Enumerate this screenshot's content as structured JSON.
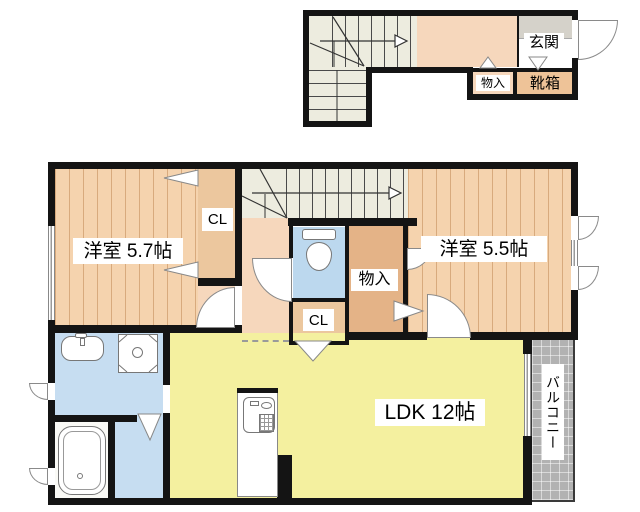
{
  "title": "apartment floor plan",
  "floor1": {
    "entrance": "玄関",
    "storage": "物入",
    "shoe_box": "靴箱"
  },
  "floor2": {
    "bedroom_left": "洋室 5.7帖",
    "bedroom_right": "洋室 5.5帖",
    "closet_left": "CL",
    "closet_center": "CL",
    "storage": "物入",
    "ldk": "LDK 12帖",
    "balcony": "バルコニー"
  },
  "colors": {
    "wall": "#141414",
    "wood_floor": "#f5d3ae",
    "hallway": "#f6d7bc",
    "closet": "#ecc79e",
    "storage": "#e4b387",
    "stairs": "#edecdf",
    "water_area": "#c6ddf1",
    "toilet": "#bcd8ee",
    "ldk": "#f4f09f",
    "entrance_tile": "#d5d2ca",
    "shoe_box": "#eec398",
    "balcony": "#b2b2b2"
  }
}
